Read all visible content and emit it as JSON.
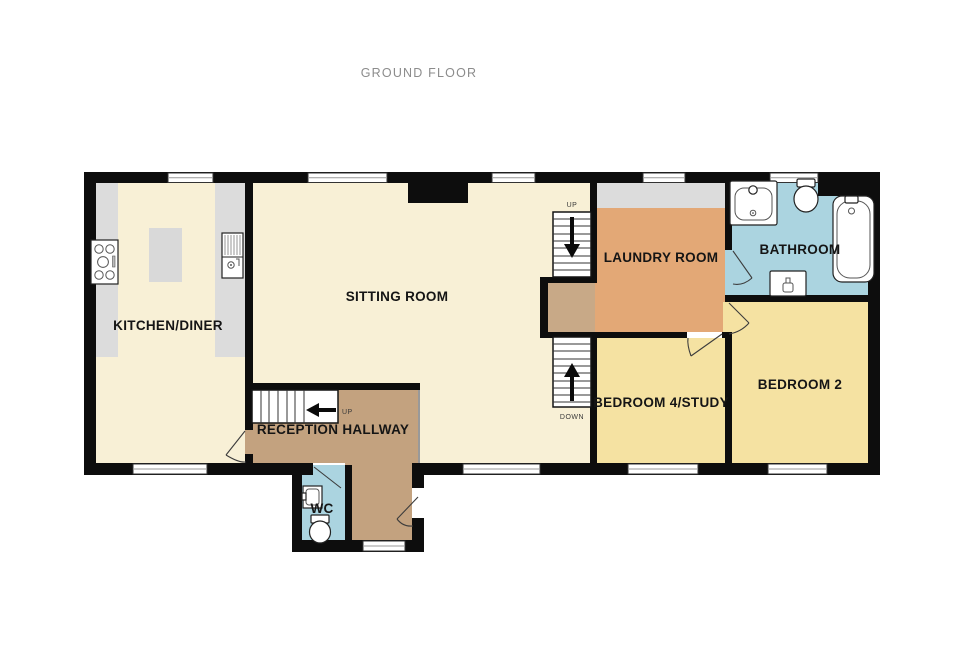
{
  "title": "GROUND FLOOR",
  "rooms": {
    "kitchen_diner": "KITCHEN/DINER",
    "sitting_room": "SITTING ROOM",
    "laundry_room": "LAUNDRY ROOM",
    "bathroom": "BATHROOM",
    "bedroom4_study": "BEDROOM 4/STUDY",
    "bedroom2": "BEDROOM 2",
    "reception_hallway": "RECEPTION HALLWAY",
    "wc": "WC"
  },
  "stairs": {
    "main_up": "UP",
    "main_down": "DOWN",
    "hall_up": "UP"
  },
  "fixtures": [
    "hob-icon",
    "kitchen-sink-icon",
    "kitchen-island",
    "bathroom-basin-icon",
    "toilet-icon",
    "bathtub-icon",
    "radiator-icon",
    "wc-basin-icon",
    "wc-toilet-icon",
    "fireplace-chimney"
  ],
  "colors": {
    "wall": "#0D0D0D",
    "room_cream": "#F8F0D6",
    "room_yellow": "#F5E2A2",
    "room_orange": "#E3A876",
    "room_blue": "#ABD4E0",
    "room_tan": "#C3A27F",
    "counter_gray": "#DCDCDC",
    "title_gray": "#8C8C8C"
  }
}
